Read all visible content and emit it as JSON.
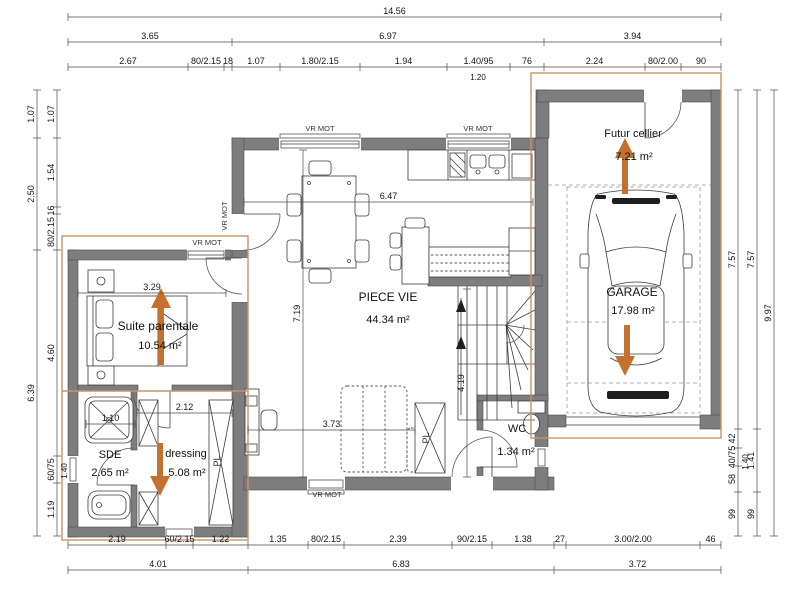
{
  "plan": {
    "rooms": [
      {
        "name": "Suite parentale",
        "area": "10.54 m²"
      },
      {
        "name": "SDE",
        "area": "2.65 m²"
      },
      {
        "name": "dressing",
        "area": "5.08 m²"
      },
      {
        "name": "PIECE VIE",
        "area": "44.34 m²"
      },
      {
        "name": "WC",
        "area": "1.34 m²"
      },
      {
        "name": "Futur cellier",
        "area": "7.21 m²"
      },
      {
        "name": "GARAGE",
        "area": "17.98 m²"
      }
    ],
    "labels": {
      "vr_mot": "VR MOT",
      "pl": "PL"
    },
    "colors": {
      "arrow_orange": "#c4702e",
      "overlay_orange": "#cc9166",
      "wall_gray": "#7d7d7d"
    },
    "dims": {
      "top1": "14.56",
      "top2": [
        "3.65",
        "6.97",
        "3.94"
      ],
      "top3": [
        "2.67",
        "80/2.15",
        "18",
        "1.07",
        "1.80/2.15",
        "1.94",
        "1.40/95",
        "76",
        "2.24",
        "80/2.00",
        "90"
      ],
      "top3_sub": "1.20",
      "left_outer": [
        "1.07",
        "2.50",
        "6.39"
      ],
      "left_inner": [
        "1.07",
        "1.54",
        "16",
        "80/2.15",
        "4.60",
        "60/75",
        "1.19"
      ],
      "left_inner_sub": "1.40",
      "right1": [
        "7.57",
        "42",
        "40/75",
        "58",
        "99"
      ],
      "right1_sub": "1.40",
      "right2": [
        "7.57",
        "1.41",
        "99"
      ],
      "right3": "9.97",
      "bottom1": [
        "2.19",
        "60/2.15",
        "1.22",
        "1.35",
        "80/2.15",
        "2.39",
        "90/2.15",
        "1.38",
        "27",
        "3.00/2.00",
        "46"
      ],
      "bottom2": [
        "4.01",
        "6.83",
        "3.72"
      ],
      "interior": {
        "suite_w": "3.29",
        "sde_w": "1.10",
        "dressing_w": "2.12",
        "pv_w": "6.47",
        "pv_h": "7.19",
        "pv_b": "3.73",
        "hall_h": "4.19"
      }
    }
  }
}
